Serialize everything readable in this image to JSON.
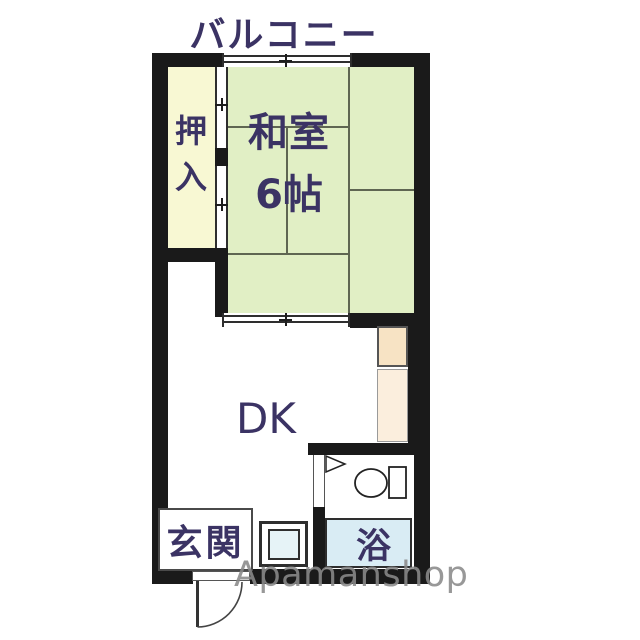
{
  "balcony": {
    "label": "バルコニー"
  },
  "rooms": {
    "closet": {
      "label": "押入"
    },
    "washitsu": {
      "name": "和室",
      "size": "6帖"
    },
    "dk": {
      "name": "DK"
    },
    "genkan": {
      "name": "玄関"
    },
    "bath": {
      "name": "浴"
    }
  },
  "fixtures": {
    "balcony_window": "sliding-window",
    "washitsu_dk_partition": "sliding-door",
    "closet_partition": "fusuma-sliding-door",
    "kitchen_units": "kitchen-counter",
    "toilet": "toilet-bowl-with-tank",
    "toilet_door": "door-wedge",
    "washer_space": "washing-machine-pan",
    "entrance_door": "hinged-door-swing"
  },
  "watermark": {
    "text": "Apamanshop"
  },
  "colors": {
    "tatami_green": "#e1efc5",
    "closet_cream": "#f8f8d3",
    "bath_blue": "#d9ecf4",
    "kitchen_peach_upper": "#f7e3c4",
    "kitchen_peach_lower": "#fbeedd",
    "washer_blue": "#e6f3f7",
    "label_purple": "#3b3364",
    "wall_black": "#1a1a1a",
    "watermark_gray": "#8a8a8a"
  }
}
